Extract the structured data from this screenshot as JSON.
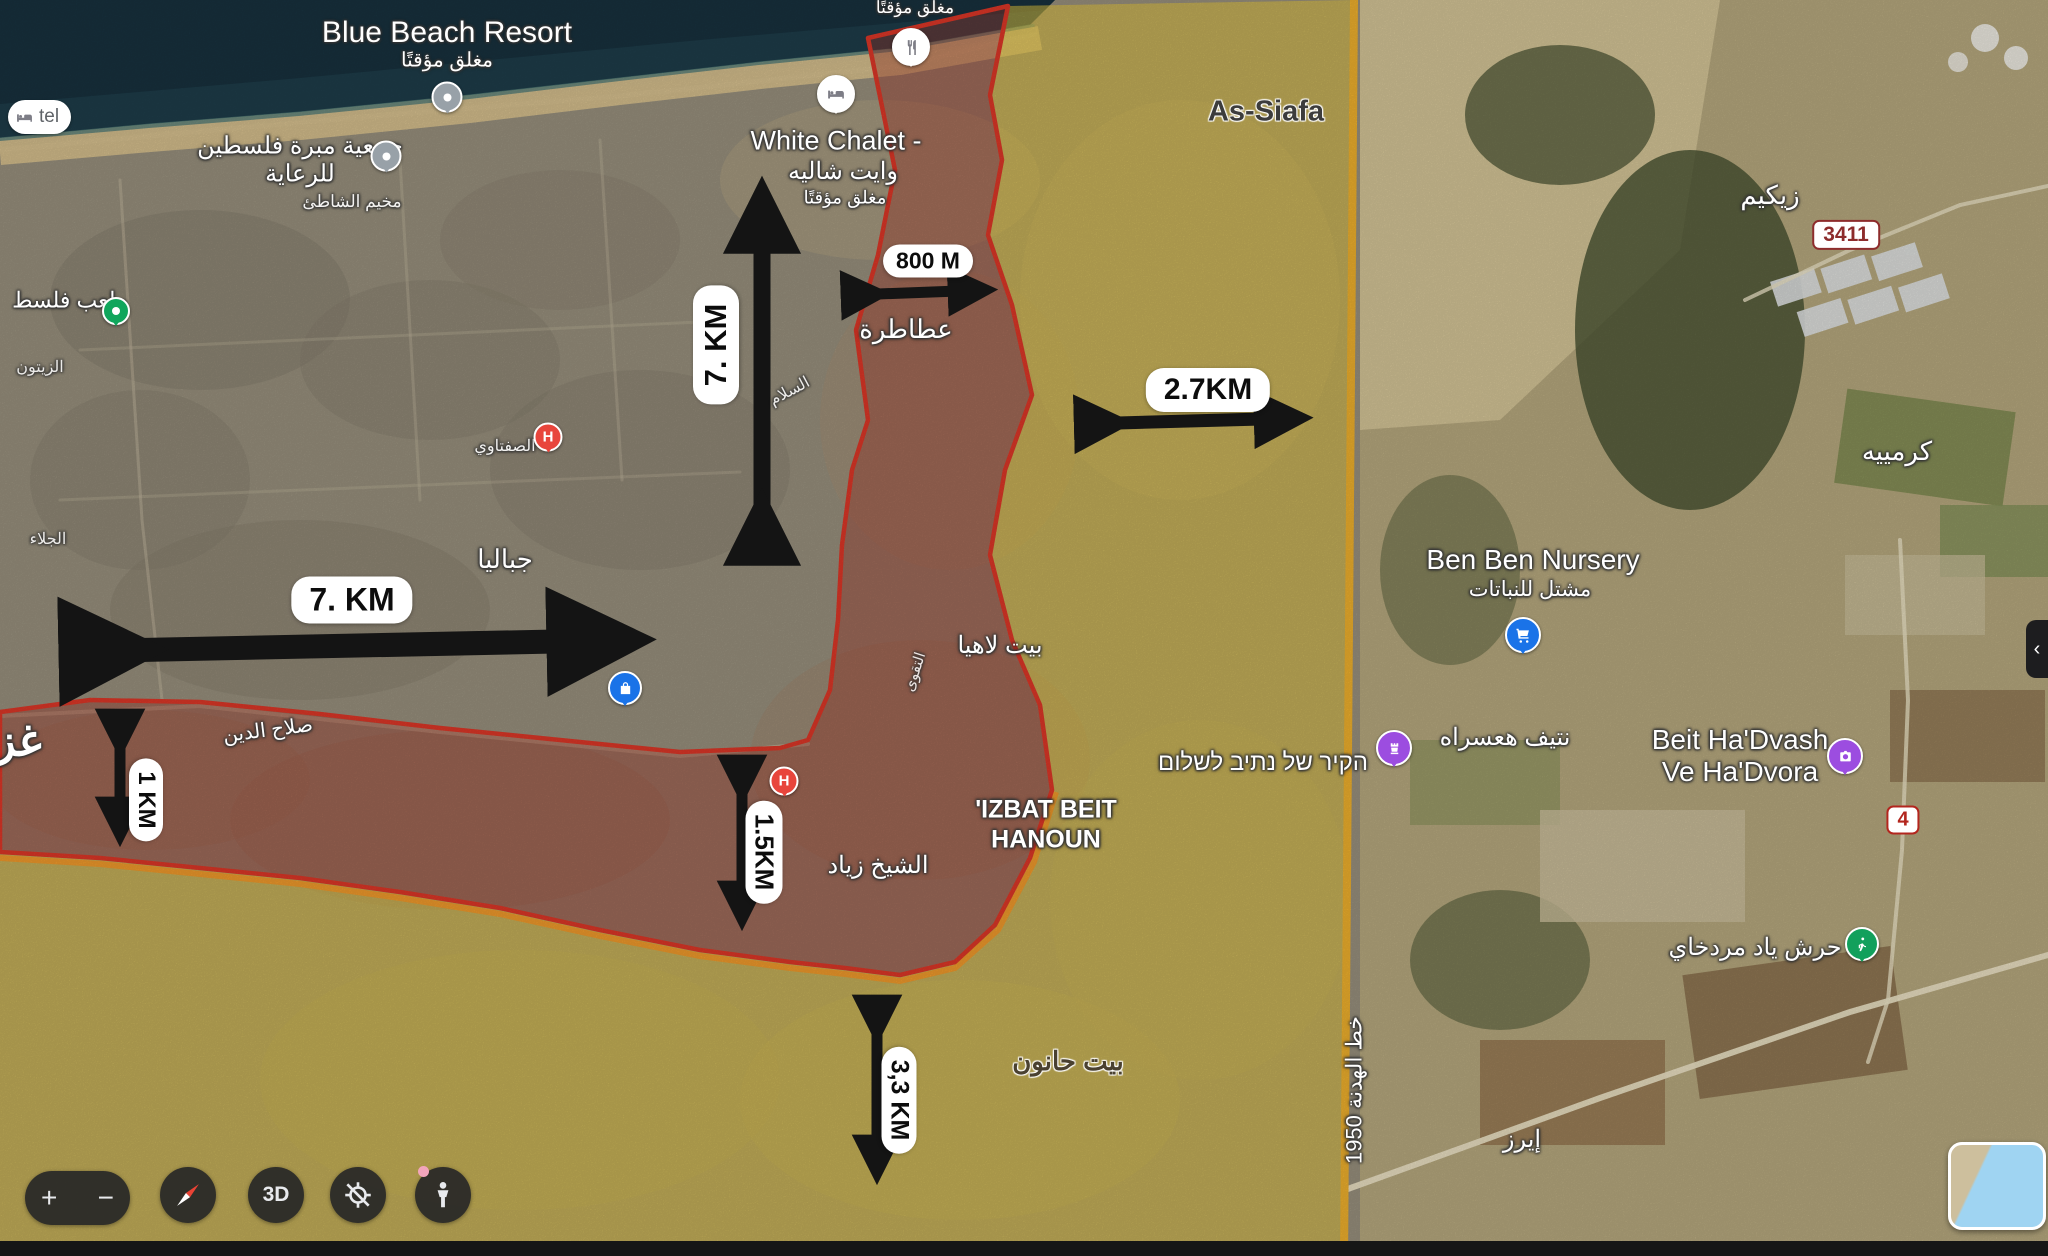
{
  "map_overlays": {
    "measurements": {
      "vertical_7km": "7. KM",
      "horizontal_7km": "7. KM",
      "m800": "800 M",
      "km_2_7": "2.7KM",
      "km_1": "1 KM",
      "km_1_5": "1.5KM",
      "km_3_3": "3,3 KM"
    },
    "armistice_line_label": "خط الهدنة 1950",
    "gaza_partial": "غز"
  },
  "places": {
    "blue_beach": "Blue Beach Resort",
    "closed_temp": "مغلق مؤقتًا",
    "charity": "جمعية مبرة فلسطين للرعاية",
    "shati_camp": "مخيم الشاطئ",
    "white_chalet_en": "White Chalet -",
    "white_chalet_ar": "وايت شاليه",
    "atatra": "عطاطرة",
    "as_siafa": "As-Siafa",
    "stadium_partial": "ملعب فلسط",
    "zeitoun": "الزيتون",
    "jalaa": "الجلاء",
    "saftawi": "الصفتاوي",
    "salam_st": "السلام",
    "taqwa_st": "التقوى",
    "jabalia": "جباليا",
    "beit_lahia": "بيت لاهيا",
    "salah_aldin": "صلاح الدين",
    "sheikh_zayed": "الشيخ زياد",
    "izbat_line1": "'IZBAT BEIT",
    "izbat_line2": "HANOUN",
    "beit_hanoun": "بيت حانون",
    "wall_hebrew": "הקיר של נתיב לשלום",
    "netiv_haasara": "نتيف هعسراه",
    "beit_hadvash_line1": "Beit Ha'Dvash",
    "beit_hadvash_line2": "Ve Ha'Dvora",
    "yad_mordechai_grove": "حرش ياد مردخاي",
    "zikim": "زيكيم",
    "karmiya": "كرمييه",
    "ben_ben": "Ben Ben Nursery",
    "ben_ben_ar": "مشتل للنباتات",
    "erez": "إيرز",
    "hotel_partial": "tel"
  },
  "badges": {
    "route_3411": "3411",
    "route_4": "4"
  },
  "controls": {
    "zoom_in": "+",
    "zoom_out": "−",
    "three_d": "3D"
  },
  "colors": {
    "red_zone_border": "#e03828",
    "red_zone_fill": "rgba(168,55,40,0.42)",
    "yellow_zone_fill": "rgba(233,203,60,0.55)",
    "armistice_line": "#f2b32e",
    "orange_underline": "#f49b2a",
    "arrow": "#141414",
    "pill_bg": "#ffffff",
    "sea": "#1e3d4a"
  }
}
